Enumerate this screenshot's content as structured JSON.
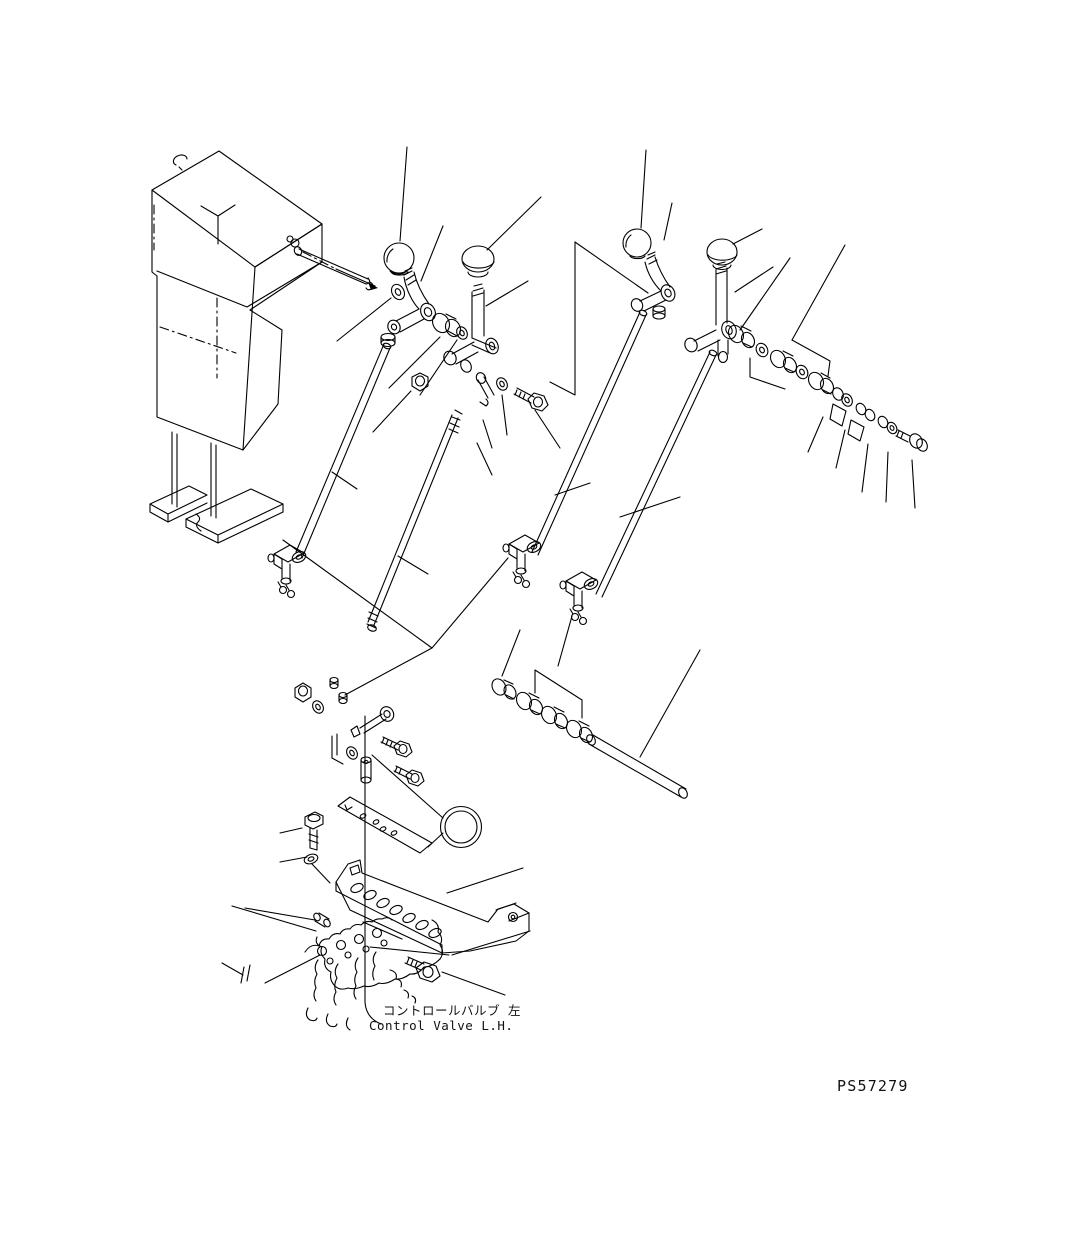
{
  "page": {
    "background": "#ffffff",
    "line_color": "#000000",
    "kind": "exploded-parts-diagram"
  },
  "callout": {
    "number": "31",
    "fill": "#007b00",
    "ring_color": "#000000",
    "number_color": "#ffffff"
  },
  "labels": {
    "caption_jp": "コントロールバルブ 左",
    "caption_en": "Control Valve L.H.",
    "drawing_code": "PS57279"
  },
  "parts": [
    "valve-stand-housing",
    "pivot-pin",
    "ball-knob",
    "control-lever",
    "control-rod",
    "rod-end-clevis",
    "bushing",
    "washer",
    "nut",
    "bolt",
    "cover-plate",
    "mounting-bracket",
    "spacer-pin",
    "control-valve-body"
  ]
}
